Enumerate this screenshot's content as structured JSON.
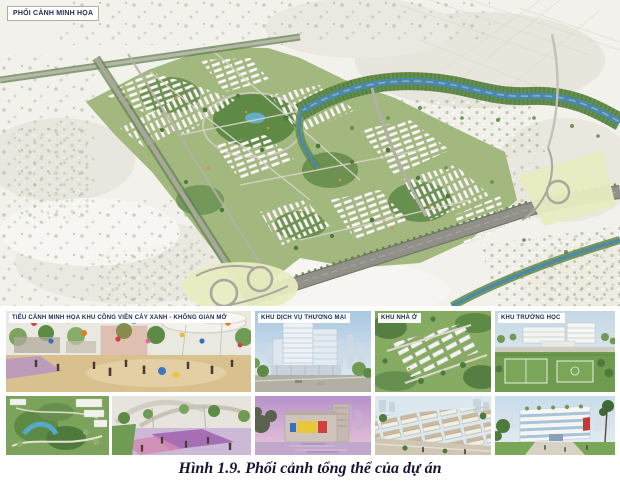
{
  "figure": {
    "main_panel": {
      "label": "PHỐI CẢNH MINH HỌA"
    },
    "sub_panels": [
      {
        "id": "parks",
        "label": "TIỂU CẢNH MINH HỌA KHU CÔNG VIÊN CÂY XANH - KHÔNG GIAN MỞ"
      },
      {
        "id": "commercial",
        "label": "KHU DỊCH VỤ THƯƠNG MẠI"
      },
      {
        "id": "housing",
        "label": "KHU NHÀ Ở"
      },
      {
        "id": "school",
        "label": "KHU TRƯỜNG HỌC"
      }
    ],
    "caption": "Hình 1.9. Phối cảnh tổng thể của dự án"
  },
  "colors": {
    "caption_text": "#141432",
    "label_text": "#1f2a52",
    "label_bg": "#ffffff",
    "river_blue": "#4d88aa",
    "park_green": "#6f9b55",
    "road_grey": "#8e8e86",
    "interchange_grass": "#e9ecc0",
    "sand": "#d9c08f"
  }
}
